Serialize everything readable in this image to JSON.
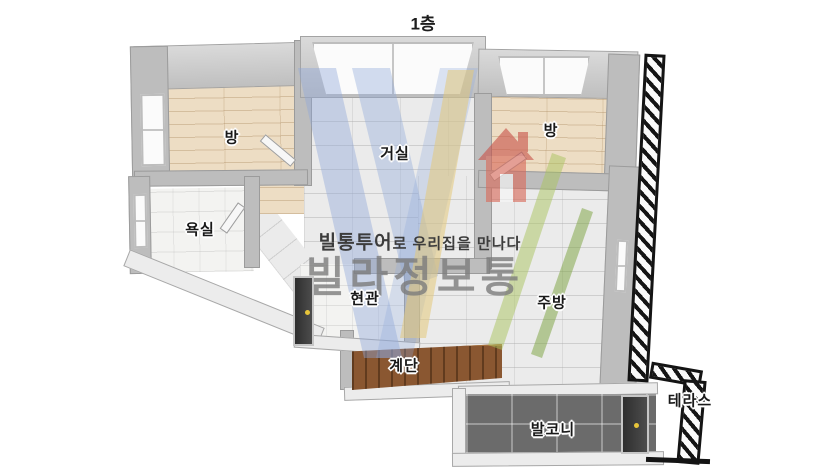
{
  "title": "1층",
  "watermark": {
    "brand_bold": "빌통투어",
    "tagline_rest": "로 우리집을 만나다",
    "brand_large": "빌라정보통",
    "logo_icon": "house-icon"
  },
  "rooms": [
    {
      "id": "bedroom-left",
      "label": "방"
    },
    {
      "id": "living-room",
      "label": "거실"
    },
    {
      "id": "bedroom-right",
      "label": "방"
    },
    {
      "id": "bathroom",
      "label": "욕실"
    },
    {
      "id": "entrance",
      "label": "현관"
    },
    {
      "id": "kitchen",
      "label": "주방"
    },
    {
      "id": "stairs",
      "label": "계단"
    },
    {
      "id": "balcony",
      "label": "발코니"
    },
    {
      "id": "terrace",
      "label": "테라스"
    }
  ],
  "colors": {
    "background": "#ffffff",
    "wall": "#bdbdbd",
    "wood_floor": "#edddc4",
    "tile_floor": "#ebebeb",
    "bath_floor": "#f3f3f1",
    "balcony_floor": "#6b6b6b",
    "stairs": "#8a5731",
    "terrace_hatch": "#141414",
    "label_text": "#191919",
    "watermark_text": "#7c7c7c",
    "logo_blue": "#8fa8da",
    "logo_yellow": "#e3c87a",
    "logo_red": "#d96a5a",
    "logo_green": "#a9c45e",
    "door_knob": "#e7c53a"
  }
}
